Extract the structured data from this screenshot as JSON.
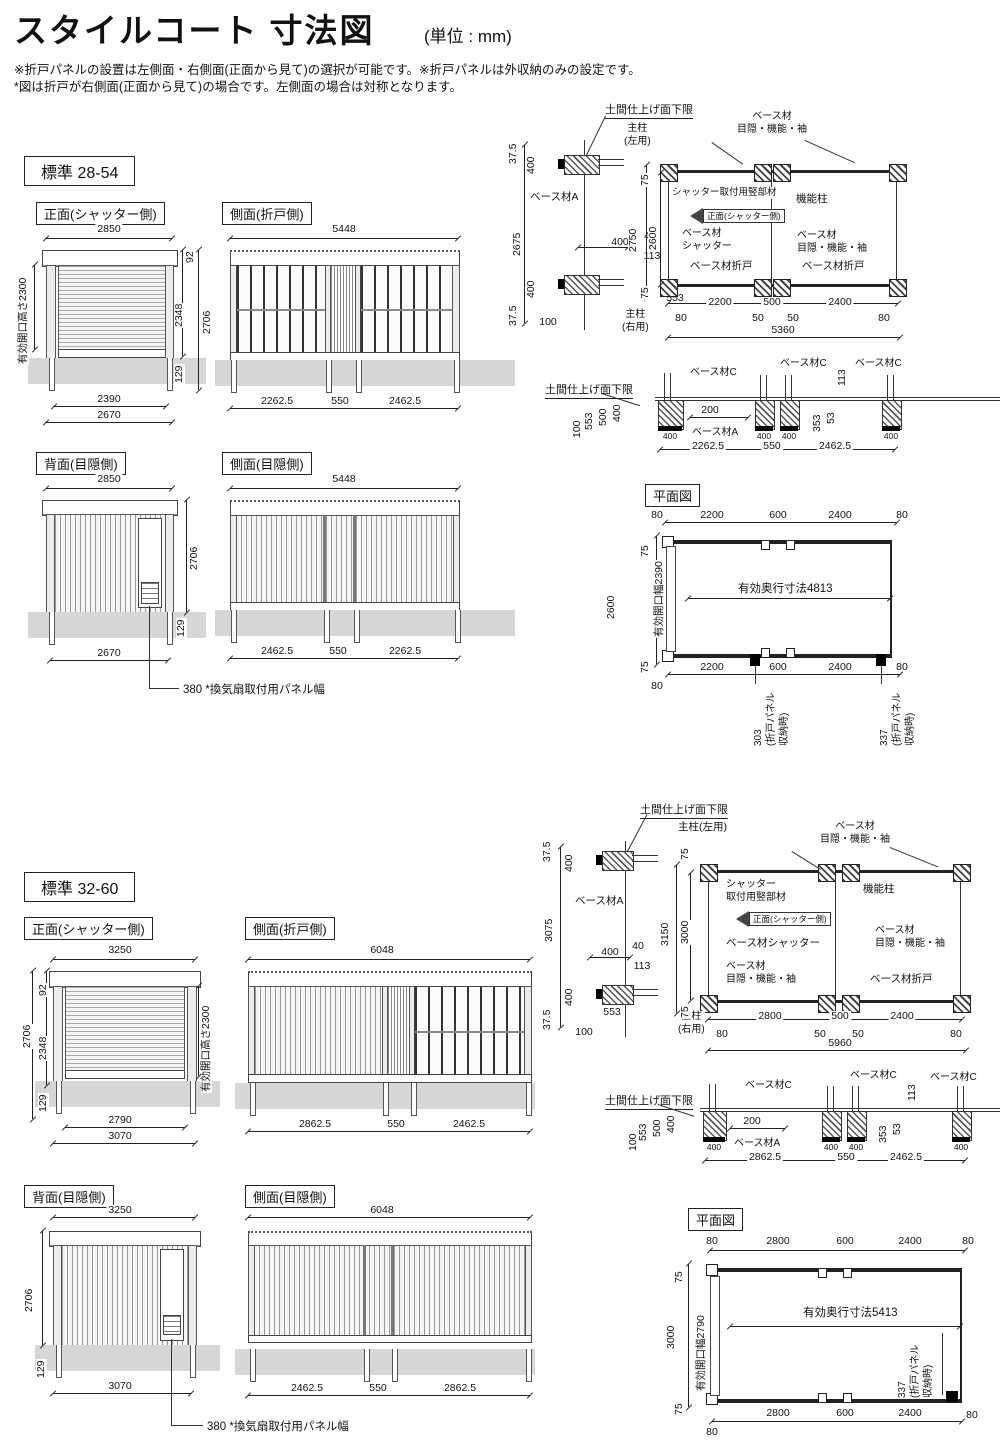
{
  "hdr": {
    "title": "スタイルコート 寸法図",
    "unit": "(単位 : mm)",
    "n1": "※折戸パネルの設置は左側面・右側面(正面から見て)の選択が可能です。※折戸パネルは外収納のみの設定です。",
    "n2": "*図は折戸が右側面(正面から見て)の場合です。左側面の場合は対称となります。"
  },
  "lbl": {
    "std1": "標準 28-54",
    "std2": "標準 32-60",
    "front": "正面(シャッター側)",
    "sideFold": "側面(折戸側)",
    "rear": "背面(目隠側)",
    "sidePriv": "側面(目隠側)",
    "plan": "平面図",
    "doma": "土間仕上げ面下限",
    "baseA": "ベース材A",
    "baseC": "ベース材C",
    "postL": "主柱(左用)",
    "postL1": "主柱",
    "postL2": "(左用)",
    "postR1": "主柱",
    "postR2": "(右用)",
    "base": "ベース材",
    "mks": "目隠・機能・袖",
    "kino": "機能柱",
    "stt": "シャッター取付用竪部材",
    "stt1": "シャッター",
    "stt2": "取付用竪部材",
    "dirArrow": "正面(シャッター側)",
    "baseShutter": "ベース材シャッター",
    "baseSh1": "ベース材",
    "baseSh2": "シャッター",
    "baseFold": "ベース材折戸",
    "vent": "380 *換気扇取付用パネル幅",
    "effH": "有効開口高さ2300",
    "stow1": "(折戸パネル",
    "stow2": "収納時)"
  },
  "s1": {
    "front": {
      "w": "2850",
      "d92": "92",
      "d2348": "2348",
      "d2706": "2706",
      "d129": "129",
      "b1": "2390",
      "b2": "2670"
    },
    "sideF": {
      "w": "5448",
      "b1": "2262.5",
      "b2": "550",
      "b3": "2462.5"
    },
    "rear": {
      "w": "2850",
      "h": "2706",
      "d129": "129",
      "b": "2670"
    },
    "sideP": {
      "w": "5448",
      "b1": "2462.5",
      "b2": "550",
      "b3": "2262.5"
    },
    "det": {
      "t375": "37.5",
      "t400": "400",
      "h": "2675",
      "b400": "400",
      "b375": "37.5",
      "d553": "553",
      "d100": "100",
      "m400": "400",
      "m40": "40",
      "m113": "113",
      "p75t": "75",
      "p2750": "2750",
      "p2600": "2600",
      "p75b": "75",
      "s1": "2200",
      "s2": "500",
      "s3": "2400",
      "o80l": "80",
      "o50l": "50",
      "o50r": "50",
      "o80r": "80",
      "total": "5360"
    },
    "base": {
      "d553": "553",
      "d500": "500",
      "d400": "400",
      "d100": "100",
      "d200": "200",
      "d113": "113",
      "d353": "353",
      "d53": "53",
      "f1": "400",
      "f2": "400",
      "f3": "400",
      "f4": "400",
      "b1": "2262.5",
      "b2": "550",
      "b3": "2462.5"
    },
    "plan": {
      "t80l": "80",
      "t1": "2200",
      "t2": "600",
      "t3": "2400",
      "t80r": "80",
      "l75t": "75",
      "lh": "2600",
      "l75b": "75",
      "open": "有効開口幅2390",
      "depth": "有効奥行寸法4813",
      "b1": "2200",
      "b2": "600",
      "b3": "2400",
      "b80r": "80",
      "b80l": "80",
      "c1": "303",
      "c2": "337"
    }
  },
  "s2": {
    "front": {
      "w": "3250",
      "d92": "92",
      "d2348": "2348",
      "d2706": "2706",
      "d129": "129",
      "b1": "2790",
      "b2": "3070"
    },
    "sideF": {
      "w": "6048",
      "b1": "2862.5",
      "b2": "550",
      "b3": "2462.5"
    },
    "rear": {
      "w": "3250",
      "h": "2706",
      "d129": "129",
      "b": "3070"
    },
    "sideP": {
      "w": "6048",
      "b1": "2462.5",
      "b2": "550",
      "b3": "2862.5"
    },
    "det": {
      "t375": "37.5",
      "t400": "400",
      "h": "3075",
      "b400": "400",
      "b375": "37.5",
      "d553": "553",
      "d100": "100",
      "m400": "400",
      "m40": "40",
      "m113": "113",
      "p75t": "75",
      "p3150": "3150",
      "p3000": "3000",
      "p75b": "75",
      "s1": "2800",
      "s2": "500",
      "s3": "2400",
      "o80l": "80",
      "o50l": "50",
      "o50r": "50",
      "o80r": "80",
      "total": "5960"
    },
    "base": {
      "d553": "553",
      "d500": "500",
      "d400": "400",
      "d100": "100",
      "d200": "200",
      "d113": "113",
      "d353": "353",
      "d53": "53",
      "f1": "400",
      "f2": "400",
      "f3": "400",
      "f4": "400",
      "b1": "2862.5",
      "b2": "550",
      "b3": "2462.5"
    },
    "plan": {
      "t80l": "80",
      "t1": "2800",
      "t2": "600",
      "t3": "2400",
      "t80r": "80",
      "l75t": "75",
      "lh": "3000",
      "l75b": "75",
      "open": "有効開口幅2790",
      "depth": "有効奥行寸法5413",
      "b1": "2800",
      "b2": "600",
      "b3": "2400",
      "b80r": "80",
      "b80l": "80",
      "c": "337"
    }
  }
}
